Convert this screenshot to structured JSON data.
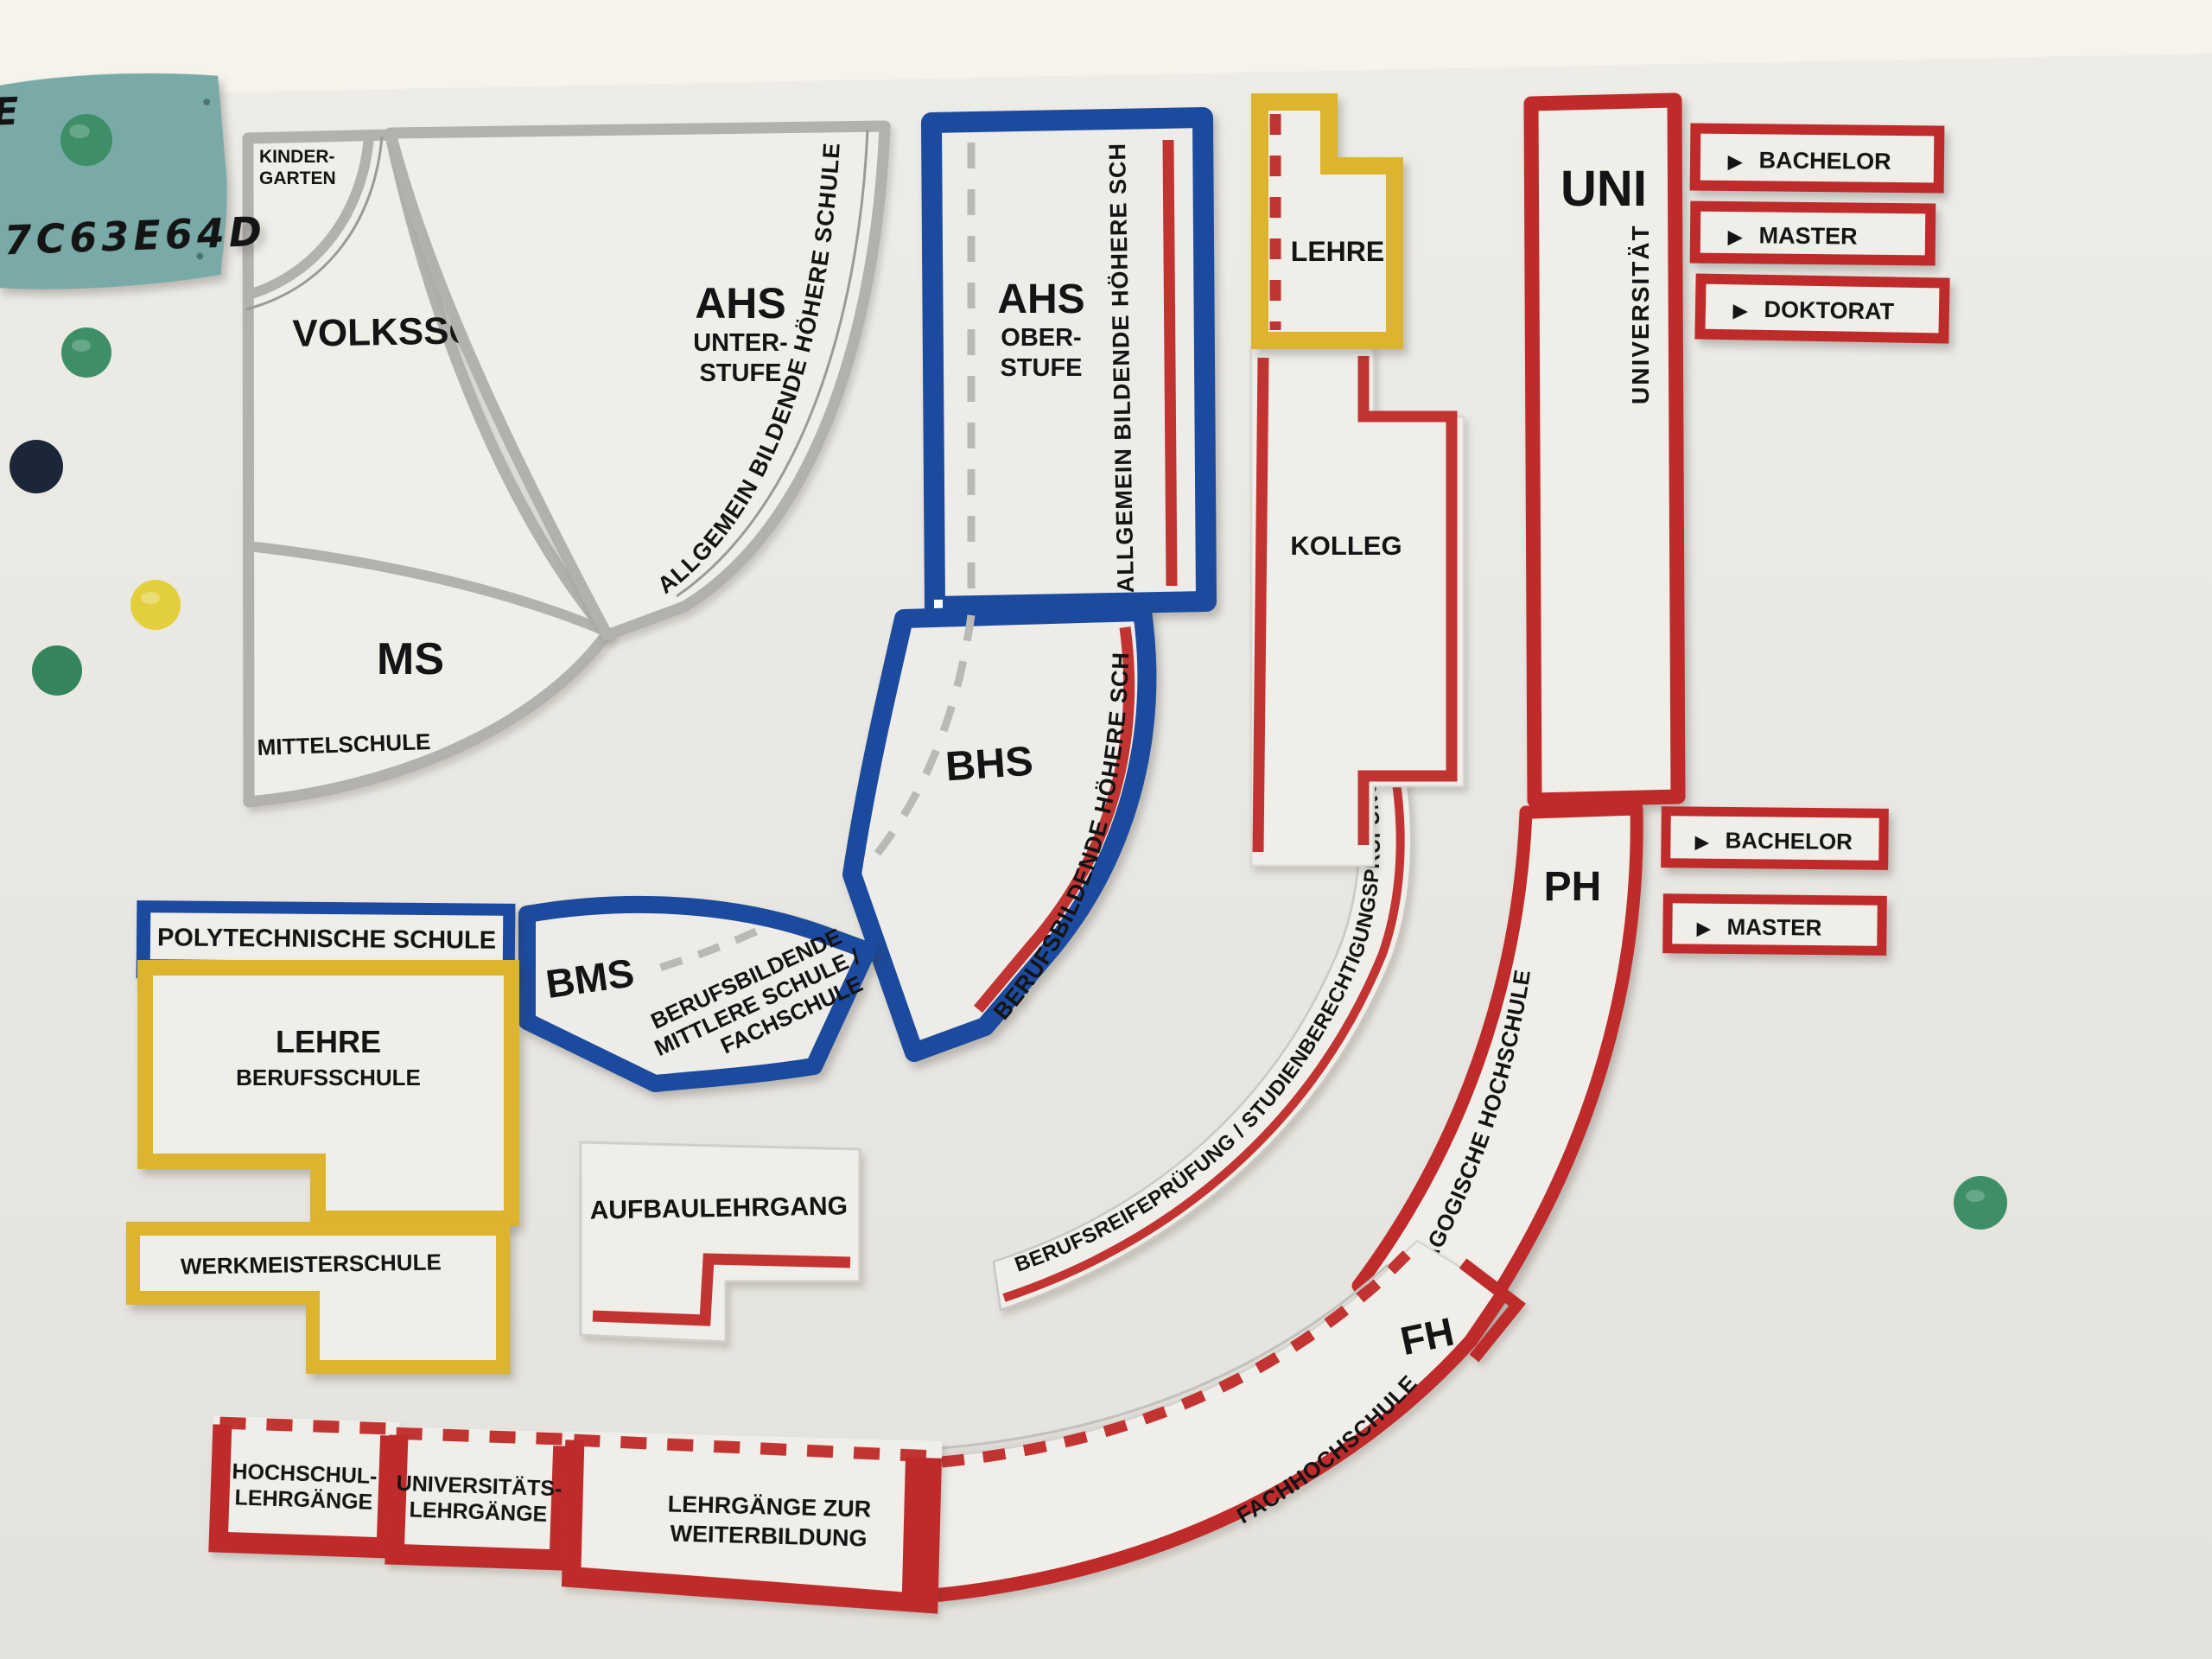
{
  "sticky_note": {
    "line1": "E",
    "line2": "7C63E64D"
  },
  "pieces": {
    "kindergarten": {
      "line1": "KINDER-",
      "line2": "GARTEN"
    },
    "volksschule": {
      "label": "VOLKSSCHULE"
    },
    "ahs_unterstufe": {
      "abbr": "AHS",
      "line1": "UNTER-",
      "line2": "STUFE",
      "side_text": "ALLGEMEIN BILDENDE HÖHERE SCHULE"
    },
    "mittelschule": {
      "abbr": "MS",
      "label": "MITTELSCHULE"
    },
    "ahs_oberstufe": {
      "abbr": "AHS",
      "line1": "OBER-",
      "line2": "STUFE",
      "side_text": "ALLGEMEIN BILDENDE HÖHERE SCHULE"
    },
    "bhs": {
      "abbr": "BHS",
      "side_text": "BERUFSBILDENDE HÖHERE SCHULE"
    },
    "bms": {
      "abbr": "BMS",
      "desc_line1": "BERUFSBILDENDE",
      "desc_line2": "MITTLERE SCHULE /",
      "desc_line3": "FACHSCHULE"
    },
    "polytechnische_schule": {
      "label": "POLYTECHNISCHE SCHULE"
    },
    "lehre": {
      "label": "LEHRE"
    },
    "lehre_berufsschule": {
      "line1": "LEHRE",
      "line2": "BERUFSSCHULE"
    },
    "werkmeisterschule": {
      "label": "WERKMEISTERSCHULE"
    },
    "kolleg": {
      "label": "KOLLEG"
    },
    "aufbaulehrgang": {
      "label": "AUFBAULEHRGANG"
    },
    "berufsreifepruefung": {
      "label": "BERUFSREIFEPRÜFUNG / STUDIENBERECHTIGUNGSPRÜFUNG"
    },
    "uni": {
      "abbr": "UNI",
      "full": "UNIVERSITÄT"
    },
    "ph": {
      "abbr": "PH",
      "full": "PÄDAGOGISCHE HOCHSCHULE"
    },
    "fh": {
      "abbr": "FH",
      "full": "FACHHOCHSCHULE"
    },
    "hochschullehrgaenge": {
      "line1": "HOCHSCHUL-",
      "line2": "LEHRGÄNGE"
    },
    "universitaetslehrgaenge": {
      "line1": "UNIVERSITÄTS-",
      "line2": "LEHRGÄNGE"
    },
    "lehrgaenge_weiterbildung": {
      "line1": "LEHRGÄNGE ZUR",
      "line2": "WEITERBILDUNG"
    }
  },
  "degree_labels_uni": [
    {
      "label": "BACHELOR"
    },
    {
      "label": "MASTER"
    },
    {
      "label": "DOKTORAT"
    }
  ],
  "degree_labels_ph": [
    {
      "label": "BACHELOR"
    },
    {
      "label": "MASTER"
    }
  ],
  "arrow_glyph": "▶",
  "colors": {
    "wall": "#f6f3ed",
    "board": "#e9e7e1",
    "piece_white": "#efeee9",
    "gray_border": "#b2b1ae",
    "blue_border": "#1c4a9e",
    "red_border": "#bf2b2b",
    "yellow_border": "#ddb42e",
    "note_teal": "#79aaa8",
    "ink_blue": "#1d3056",
    "magnet_green": "#3e8f67",
    "magnet_dark_green": "#35855c",
    "magnet_navy": "#1c2639",
    "magnet_yellow": "#e3cf3c",
    "text_black": "#141414"
  }
}
